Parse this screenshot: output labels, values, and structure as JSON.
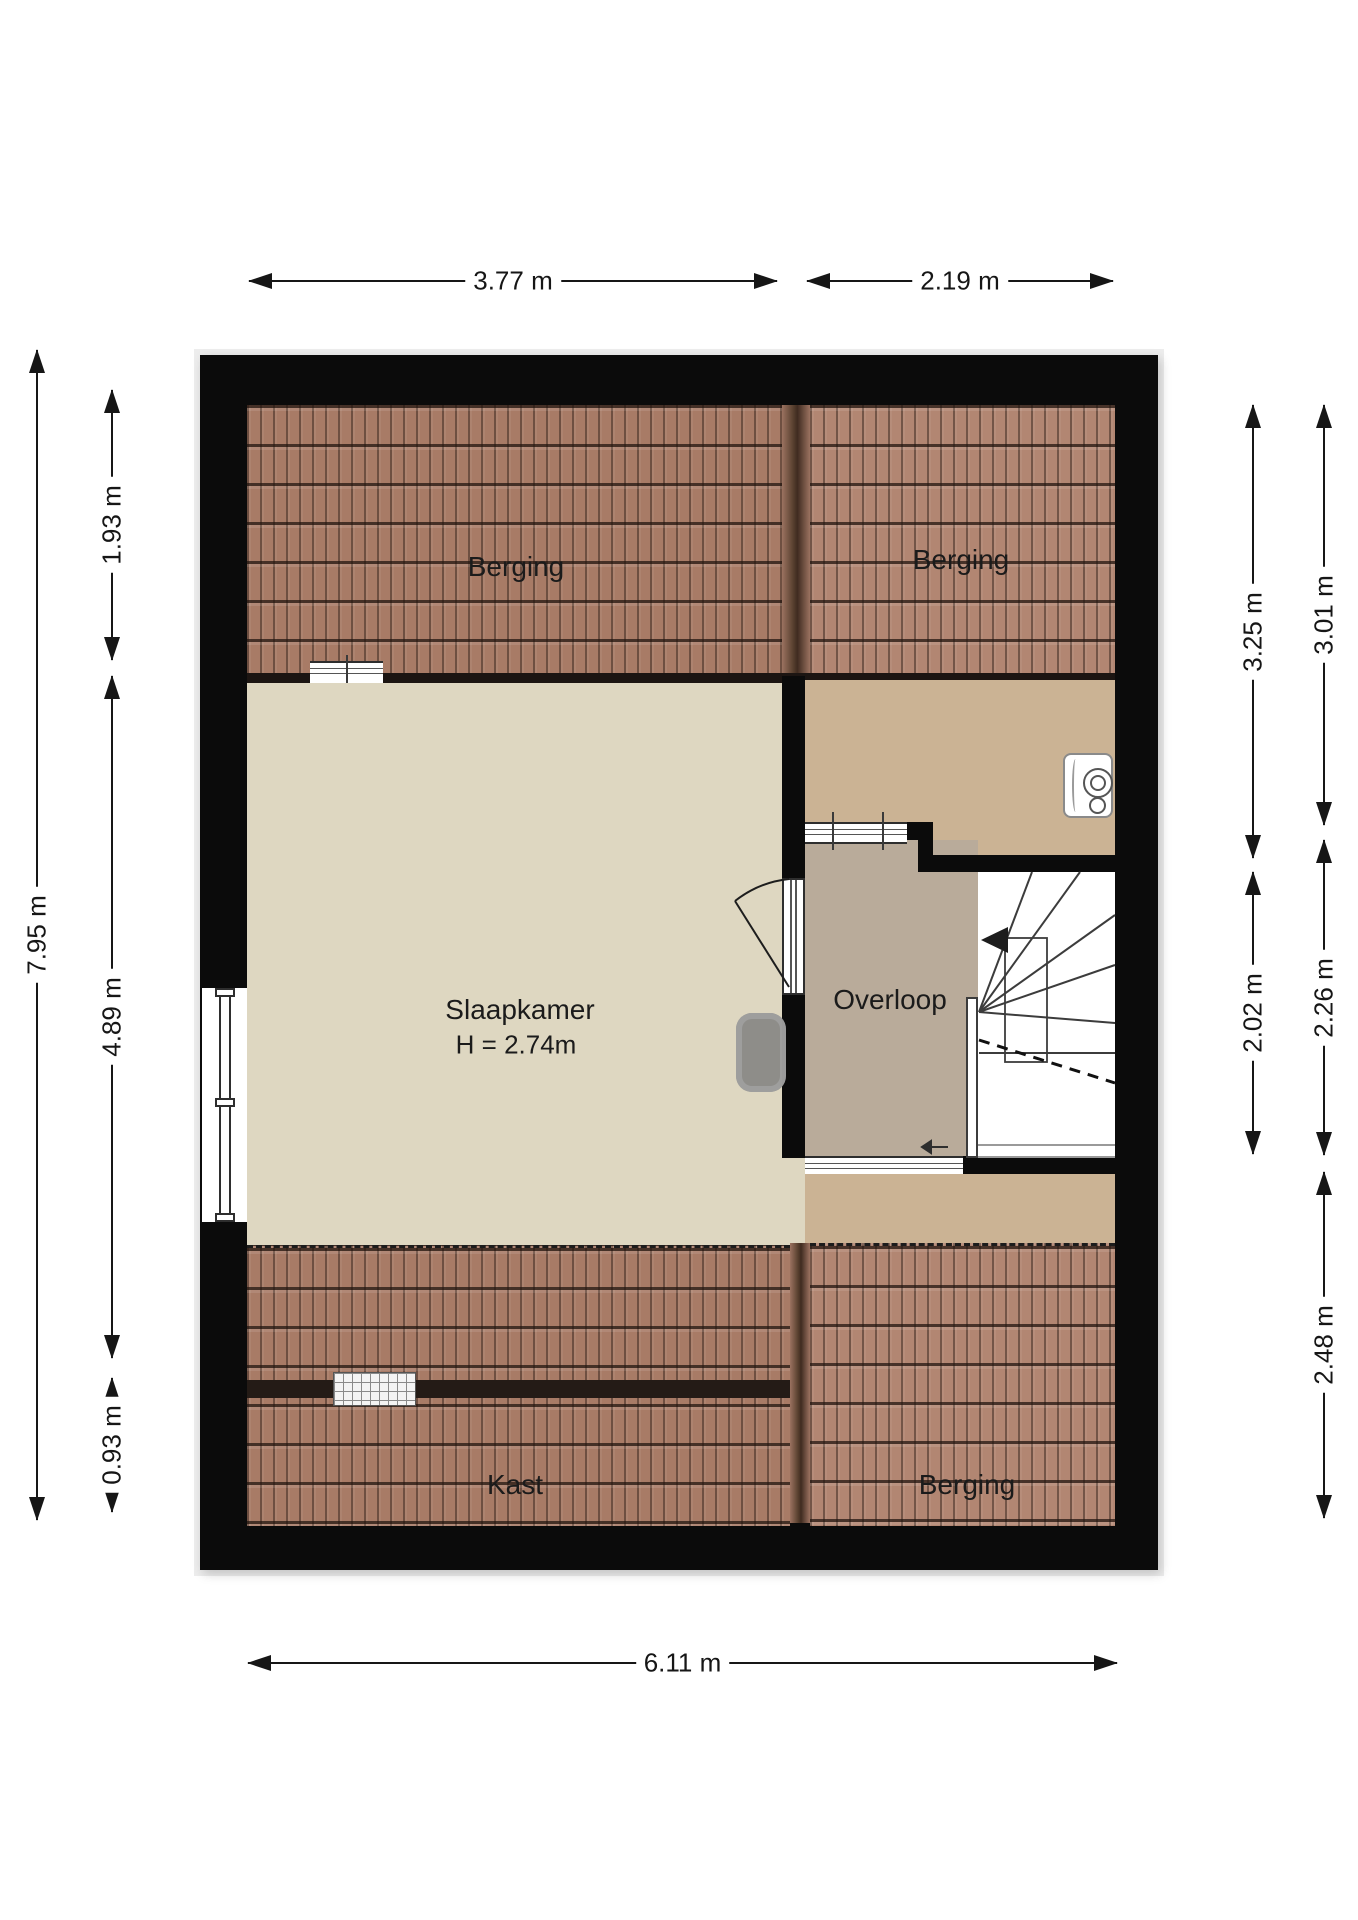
{
  "title": "Attic floor plan",
  "rooms": {
    "berging_top_left": "Berging",
    "berging_top_right": "Berging",
    "slaapkamer": "Slaapkamer",
    "slaapkamer_height": "H = 2.74m",
    "overloop": "Overloop",
    "kast": "Kast",
    "berging_bottom": "Berging"
  },
  "dimensions": {
    "top_left_width": "3.77 m",
    "top_right_width": "2.19 m",
    "bottom_total_width": "6.11 m",
    "left_total_height": "7.95 m",
    "left_top": "1.93 m",
    "left_middle": "4.89 m",
    "left_bottom": "0.93 m",
    "right_inner_top": "3.25 m",
    "right_inner_middle": "2.02 m",
    "right_outer_top": "3.01 m",
    "right_outer_middle": "2.26 m",
    "right_outer_bottom": "2.48 m"
  },
  "colors": {
    "wall": "#0b0b0b",
    "roof_tile": "#a87b66",
    "roof_tile_light": "#b28672",
    "bedroom_floor": "#ded7c1",
    "hall_upper_floor": "#cbb394",
    "landing_floor": "#b9ab9a",
    "dimension_ink": "#161616"
  }
}
